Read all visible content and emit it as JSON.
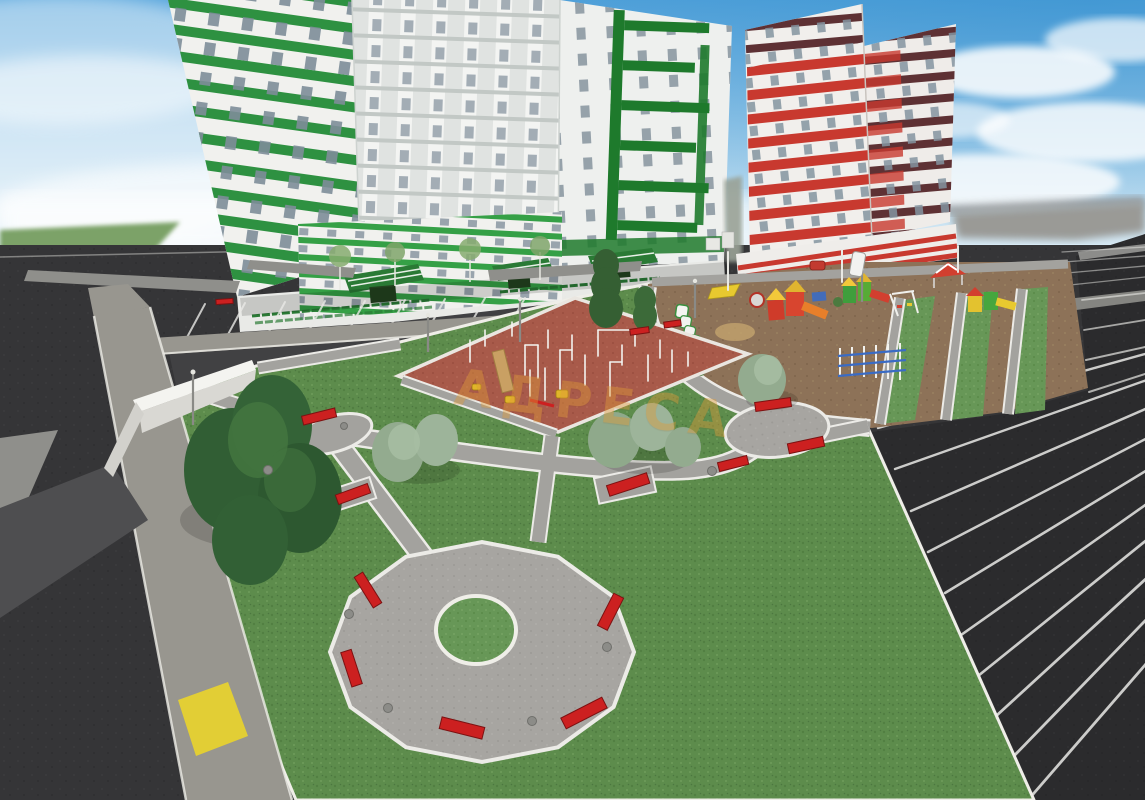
{
  "watermark": {
    "text": "АДРЕСА"
  },
  "palette": {
    "sky_top": "#5aa6dc",
    "sky_bottom": "#ecf4f8",
    "cloud_white": "#ffffff",
    "field_green": "#7ba268",
    "road_asphalt": "#3a3a3c",
    "parking_asphalt": "#2b2b2d",
    "sidewalk_gray": "#98968f",
    "curb_white": "#efeee8",
    "lawn_green": "#5d8c4c",
    "plaza_concrete": "#a7a5a1",
    "sport_court_red": "#a85a4a",
    "playground_dirt": "#8d7258",
    "bench_red": "#cc2020",
    "tactile_yellow": "#e8d22e",
    "tree_dark": "#315e34",
    "tree_sage": "#93ab8f",
    "building_white": "#f1f1ee",
    "stripe_green": "#2e9141",
    "stripe_red": "#c8392f",
    "stripe_maroon": "#5e3134",
    "canopy_green": "#2a7a35",
    "window_glass": "#8494a0",
    "train_green": "#3a8f3f",
    "watermark_orange": "#e09a38"
  }
}
